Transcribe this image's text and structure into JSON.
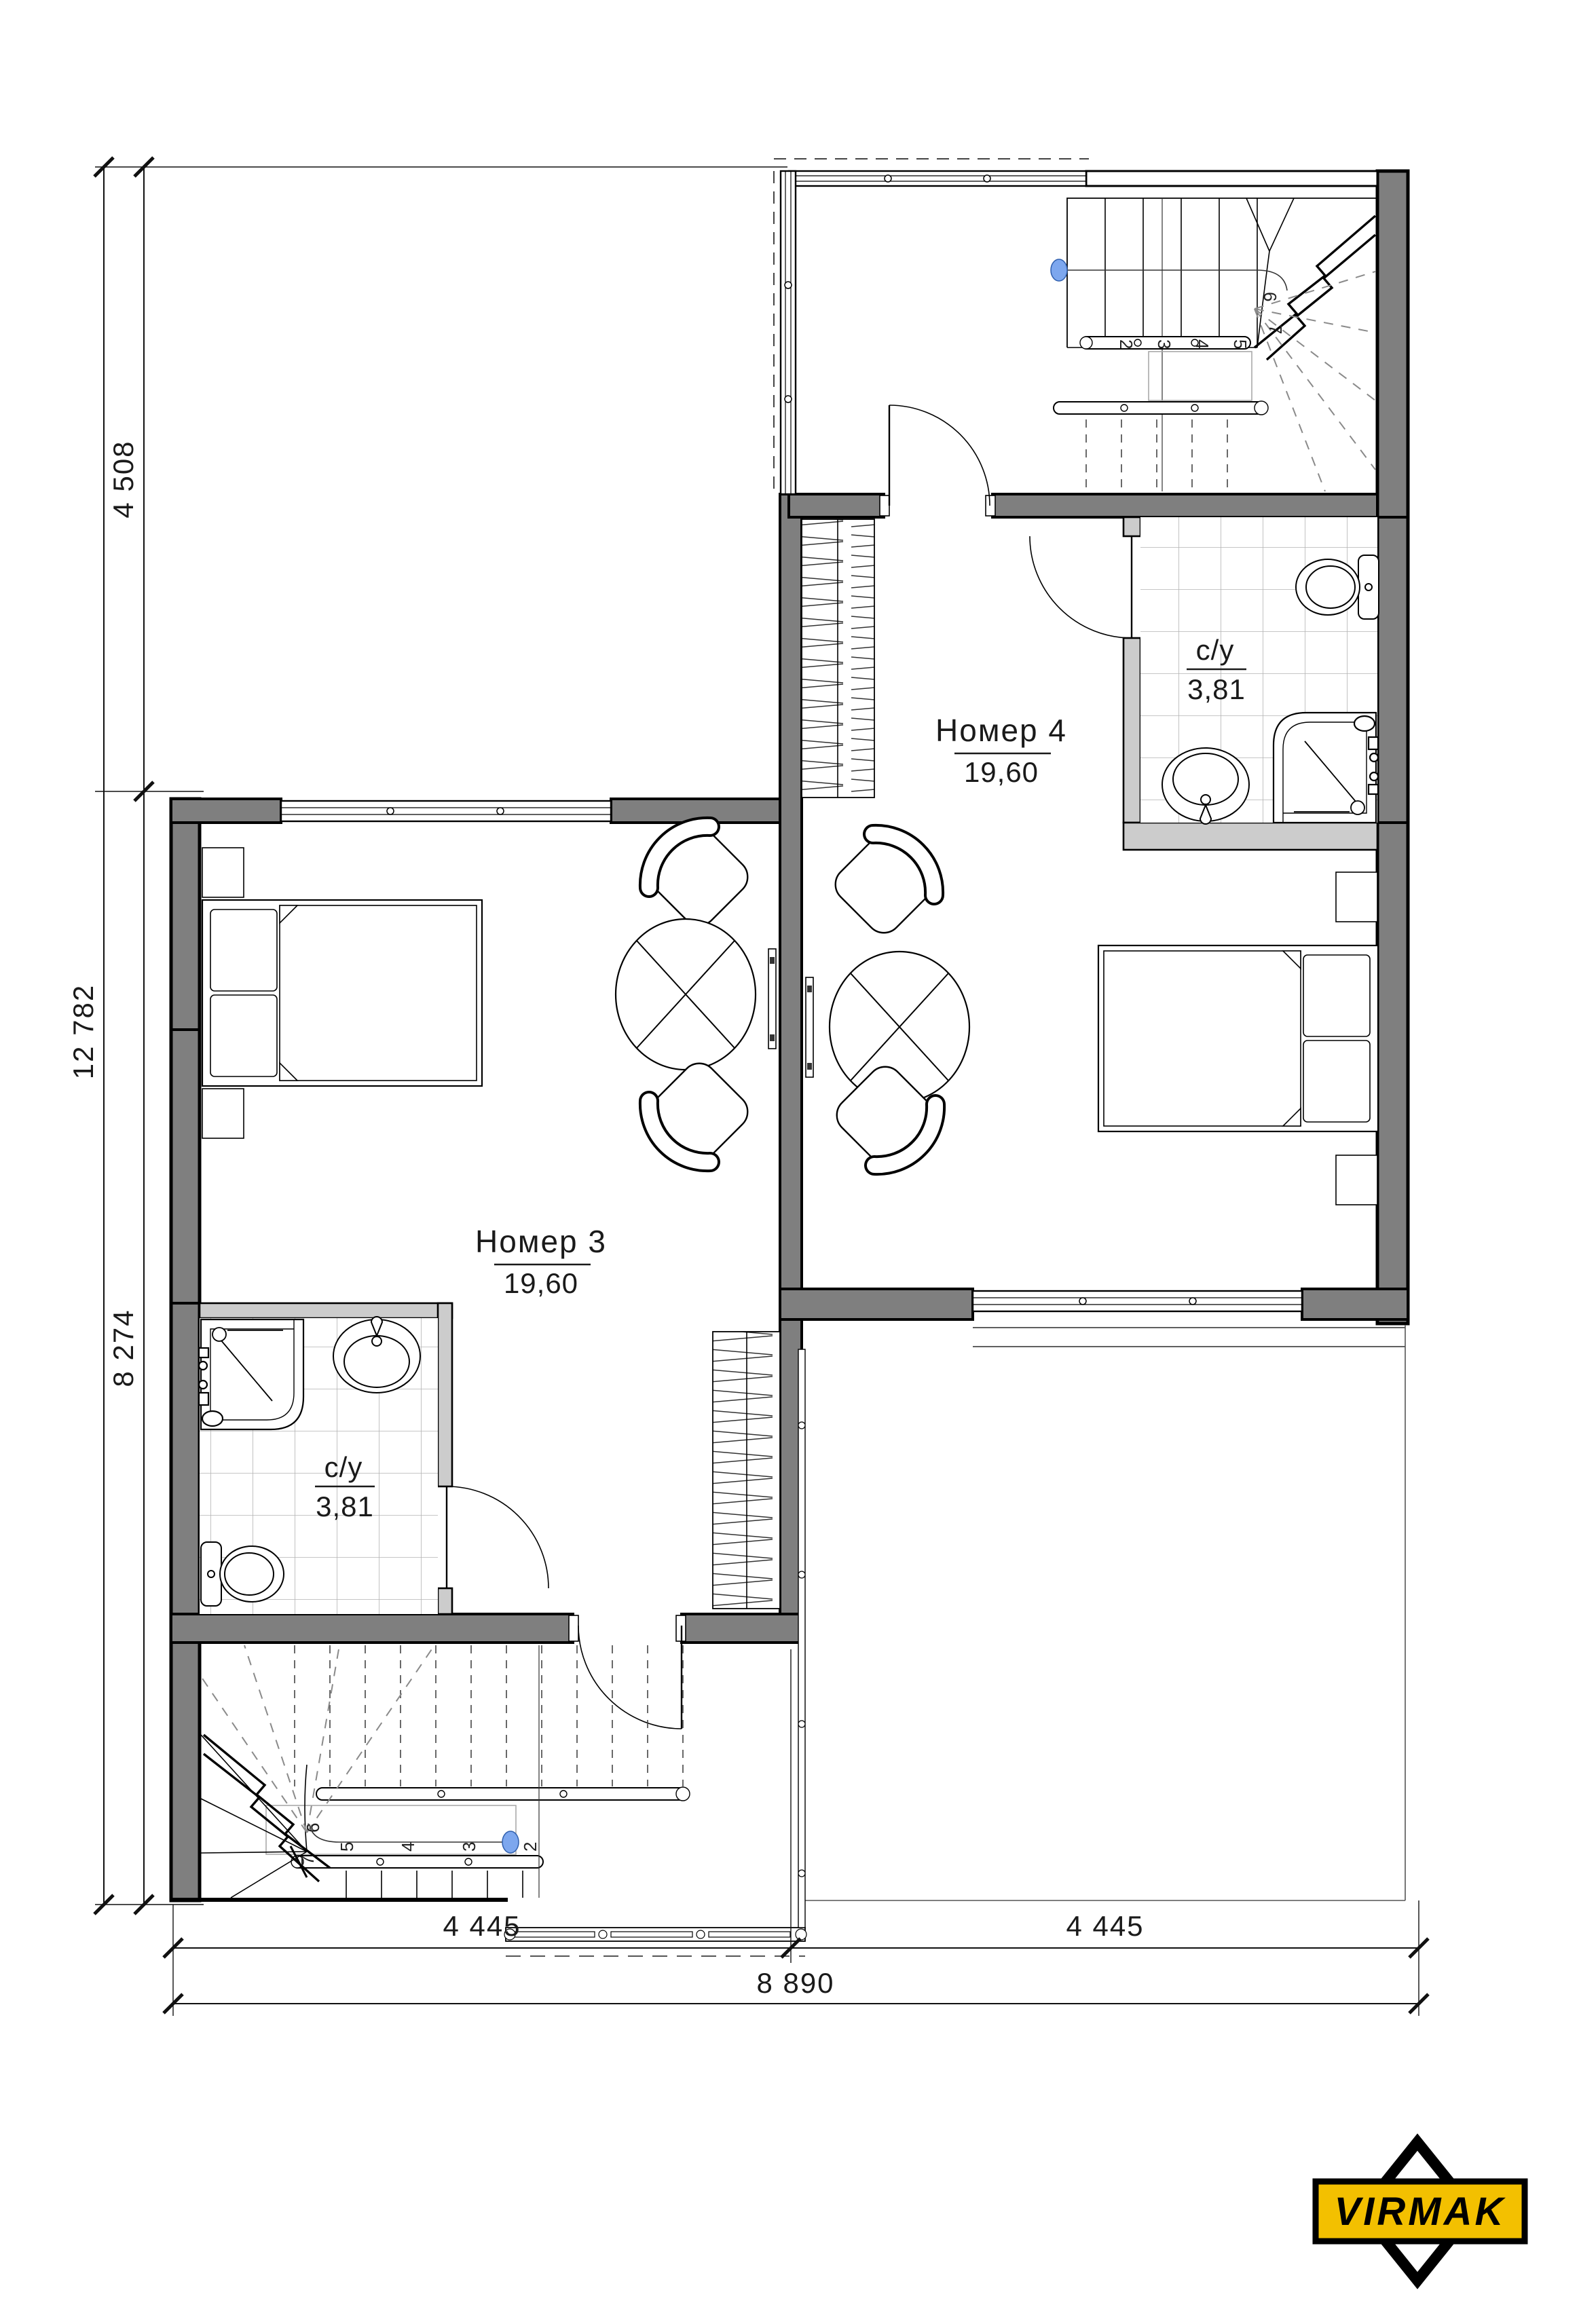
{
  "rooms": {
    "room3": {
      "name": "Номер 3",
      "area": "19,60"
    },
    "room4": {
      "name": "Номер 4",
      "area": "19,60"
    },
    "bath3": {
      "name": "с/у",
      "area": "3,81"
    },
    "bath4": {
      "name": "с/у",
      "area": "3,81"
    }
  },
  "dimensions": {
    "left_total": "12 782",
    "left_upper": "4 508",
    "left_lower": "8 274",
    "bottom_left": "4 445",
    "bottom_right": "4 445",
    "bottom_total": "8 890"
  },
  "stairs": {
    "top_steps": [
      "2",
      "3",
      "4",
      "5",
      "6",
      "7"
    ],
    "bottom_steps": [
      "2",
      "3",
      "4",
      "5",
      "6",
      "7"
    ]
  },
  "logo": {
    "text": "VIRMAK"
  },
  "colors": {
    "wall_fill": "#7f7f7f",
    "partition_fill": "#cccccc",
    "line": "#000000",
    "tile_line": "#b3b3b3",
    "marker_blue": "#7da7ee",
    "logo_yellow": "#f3c000"
  }
}
